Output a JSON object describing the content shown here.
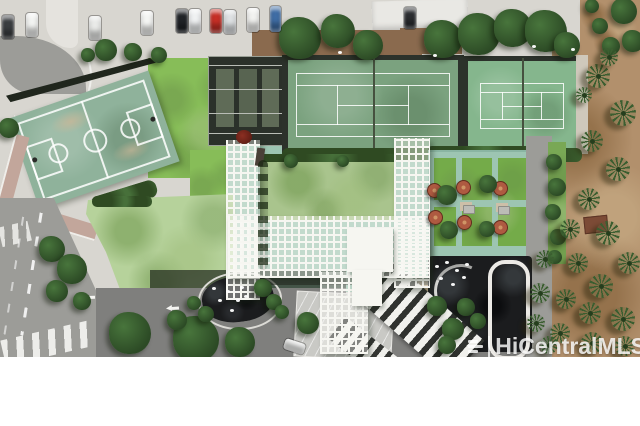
{
  "watermark": {
    "text": "HiCentralMLS"
  },
  "palette": {
    "pavement": "#d8d6d0",
    "pavement2": "#e5e3de",
    "street": "#9c9c98",
    "drive": "#7f7f7d",
    "white": "#f4f4f0",
    "courtBall": "#8fb29b",
    "courtWear": "#c8b798",
    "tennis1": "#7ba27f",
    "tennis2": "#85b68d",
    "frameDark": "#2c322b",
    "netDark": "#46513f",
    "hedge": "#47703a",
    "hedgeDark": "#2f4a22",
    "lawnBright": "#87bd58",
    "lawnPale": "#b6d29b",
    "lawnCentral": "#a9c48d",
    "lawnBbq": "#74ab49",
    "teal": "#9dc5b2",
    "trellis": "#f6f6f1",
    "tan": "#c2a69b",
    "dirt": "#b2906c",
    "palm": "#3b5e30",
    "palmDark": "#253e1d",
    "pond": "#1b1c1e",
    "umbrella": "#ae5a41",
    "treeMid": "#48753c",
    "treeDark": "#2c4a25",
    "shadow": "#20261d",
    "enclosure": "#2b312a",
    "glass": "#68755f",
    "brown": "#8a6a4e",
    "greyRoof": "#c9c9c5",
    "gazebo": "#c9b392",
    "kerb": "#cfc8bb"
  },
  "scene": {
    "description": "Aerial drone view of a condominium recreation deck: basketball court, two tennis courts, white pergola lattice, lawns, barbecue patio with umbrellas, koi pond with looped path, porte-cochere driveway, streets with crosswalks, dirt lot with palm trees.",
    "cars": [
      {
        "x": 2,
        "y": 15,
        "c": "#3a3d40"
      },
      {
        "x": 26,
        "y": 13,
        "c": "#f2f3f1"
      },
      {
        "x": 89,
        "y": 16,
        "c": "#e9eae8"
      },
      {
        "x": 141,
        "y": 11,
        "c": "#f4f5f3"
      },
      {
        "x": 176,
        "y": 9,
        "c": "#202327"
      },
      {
        "x": 189,
        "y": 9,
        "c": "#eff1f2"
      },
      {
        "x": 210,
        "y": 9,
        "c": "#c62f26"
      },
      {
        "x": 224,
        "y": 10,
        "c": "#dde0e2"
      },
      {
        "x": 247,
        "y": 8,
        "c": "#f2f2f0"
      },
      {
        "x": 270,
        "y": 6,
        "w": 11,
        "h": 26,
        "c": "#3f6da5"
      },
      {
        "x": 404,
        "y": 7,
        "w": 12,
        "h": 22,
        "c": "#2c2e31"
      },
      {
        "x": 284,
        "y": 341,
        "w": 21,
        "h": 11,
        "deg": 18,
        "c": "#f3f4f2"
      }
    ],
    "palms": [
      {
        "x": 598,
        "y": 76,
        "r": 12
      },
      {
        "x": 623,
        "y": 113,
        "r": 13
      },
      {
        "x": 592,
        "y": 141,
        "r": 11
      },
      {
        "x": 618,
        "y": 169,
        "r": 12
      },
      {
        "x": 589,
        "y": 199,
        "r": 11
      },
      {
        "x": 570,
        "y": 229,
        "r": 10
      },
      {
        "x": 608,
        "y": 233,
        "r": 12
      },
      {
        "x": 629,
        "y": 263,
        "r": 11
      },
      {
        "x": 578,
        "y": 263,
        "r": 10
      },
      {
        "x": 601,
        "y": 286,
        "r": 12
      },
      {
        "x": 566,
        "y": 299,
        "r": 10
      },
      {
        "x": 590,
        "y": 313,
        "r": 11
      },
      {
        "x": 623,
        "y": 319,
        "r": 12
      },
      {
        "x": 560,
        "y": 333,
        "r": 10
      },
      {
        "x": 592,
        "y": 343,
        "r": 11
      },
      {
        "x": 625,
        "y": 346,
        "r": 10
      },
      {
        "x": 545,
        "y": 259,
        "r": 9
      },
      {
        "x": 540,
        "y": 293,
        "r": 10
      },
      {
        "x": 536,
        "y": 323,
        "r": 9
      },
      {
        "x": 549,
        "y": 345,
        "r": 9
      },
      {
        "x": 609,
        "y": 57,
        "r": 9
      },
      {
        "x": 584,
        "y": 95,
        "r": 8
      }
    ],
    "trees": [
      {
        "x": 300,
        "y": 38,
        "r": 21
      },
      {
        "x": 338,
        "y": 31,
        "r": 17
      },
      {
        "x": 368,
        "y": 45,
        "r": 15
      },
      {
        "x": 443,
        "y": 39,
        "r": 19
      },
      {
        "x": 479,
        "y": 34,
        "r": 21
      },
      {
        "x": 513,
        "y": 28,
        "r": 19
      },
      {
        "x": 546,
        "y": 31,
        "r": 21
      },
      {
        "x": 567,
        "y": 45,
        "r": 13
      },
      {
        "x": 106,
        "y": 50,
        "r": 11
      },
      {
        "x": 133,
        "y": 52,
        "r": 9
      },
      {
        "x": 159,
        "y": 55,
        "r": 8
      },
      {
        "x": 88,
        "y": 55,
        "r": 7
      },
      {
        "x": 624,
        "y": 11,
        "r": 13
      },
      {
        "x": 633,
        "y": 41,
        "r": 11
      },
      {
        "x": 611,
        "y": 46,
        "r": 9
      },
      {
        "x": 600,
        "y": 26,
        "r": 8
      },
      {
        "x": 592,
        "y": 6,
        "r": 7
      },
      {
        "x": 9,
        "y": 128,
        "r": 10
      },
      {
        "x": 52,
        "y": 249,
        "r": 13
      },
      {
        "x": 72,
        "y": 269,
        "r": 15
      },
      {
        "x": 57,
        "y": 291,
        "r": 11
      },
      {
        "x": 82,
        "y": 301,
        "r": 9
      },
      {
        "x": 130,
        "y": 333,
        "r": 21
      },
      {
        "x": 196,
        "y": 339,
        "r": 23
      },
      {
        "x": 240,
        "y": 342,
        "r": 15
      },
      {
        "x": 308,
        "y": 323,
        "r": 11
      },
      {
        "x": 177,
        "y": 320,
        "r": 10
      },
      {
        "x": 263,
        "y": 288,
        "r": 9
      },
      {
        "x": 274,
        "y": 302,
        "r": 8
      },
      {
        "x": 206,
        "y": 314,
        "r": 8
      },
      {
        "x": 194,
        "y": 303,
        "r": 7
      },
      {
        "x": 282,
        "y": 312,
        "r": 7
      },
      {
        "x": 437,
        "y": 306,
        "r": 10
      },
      {
        "x": 453,
        "y": 329,
        "r": 11
      },
      {
        "x": 466,
        "y": 307,
        "r": 9
      },
      {
        "x": 447,
        "y": 345,
        "r": 9
      },
      {
        "x": 478,
        "y": 321,
        "r": 8
      },
      {
        "x": 554,
        "y": 162,
        "r": 8
      },
      {
        "x": 557,
        "y": 187,
        "r": 9
      },
      {
        "x": 553,
        "y": 212,
        "r": 8
      },
      {
        "x": 558,
        "y": 237,
        "r": 8
      },
      {
        "x": 555,
        "y": 257,
        "r": 7
      },
      {
        "x": 291,
        "y": 161,
        "r": 7
      },
      {
        "x": 343,
        "y": 161,
        "r": 6
      },
      {
        "x": 447,
        "y": 195,
        "r": 10
      },
      {
        "x": 488,
        "y": 184,
        "r": 9
      },
      {
        "x": 449,
        "y": 230,
        "r": 9
      },
      {
        "x": 487,
        "y": 229,
        "r": 8
      }
    ],
    "umbrellas": [
      {
        "x": 433,
        "y": 189
      },
      {
        "x": 462,
        "y": 186
      },
      {
        "x": 499,
        "y": 187
      },
      {
        "x": 434,
        "y": 216
      },
      {
        "x": 463,
        "y": 221
      },
      {
        "x": 499,
        "y": 226
      }
    ],
    "tables": [
      {
        "x": 463,
        "y": 205
      },
      {
        "x": 498,
        "y": 206
      }
    ],
    "arrows": [
      {
        "x": 166,
        "y": 305,
        "deg": -4
      },
      {
        "x": 240,
        "y": 336,
        "deg": -6
      },
      {
        "x": 82,
        "y": 294,
        "deg": -2
      }
    ],
    "sparkles": [
      {
        "x": 226,
        "y": 290
      },
      {
        "x": 236,
        "y": 299
      },
      {
        "x": 218,
        "y": 299
      },
      {
        "x": 230,
        "y": 309
      },
      {
        "x": 244,
        "y": 295
      },
      {
        "x": 212,
        "y": 287
      },
      {
        "x": 240,
        "y": 286
      },
      {
        "x": 435,
        "y": 265
      },
      {
        "x": 445,
        "y": 261
      },
      {
        "x": 455,
        "y": 269
      },
      {
        "x": 465,
        "y": 263
      },
      {
        "x": 439,
        "y": 277
      },
      {
        "x": 451,
        "y": 283
      },
      {
        "x": 462,
        "y": 276
      },
      {
        "x": 338,
        "y": 51
      },
      {
        "x": 433,
        "y": 54
      },
      {
        "x": 532,
        "y": 45
      },
      {
        "x": 571,
        "y": 48
      }
    ]
  }
}
